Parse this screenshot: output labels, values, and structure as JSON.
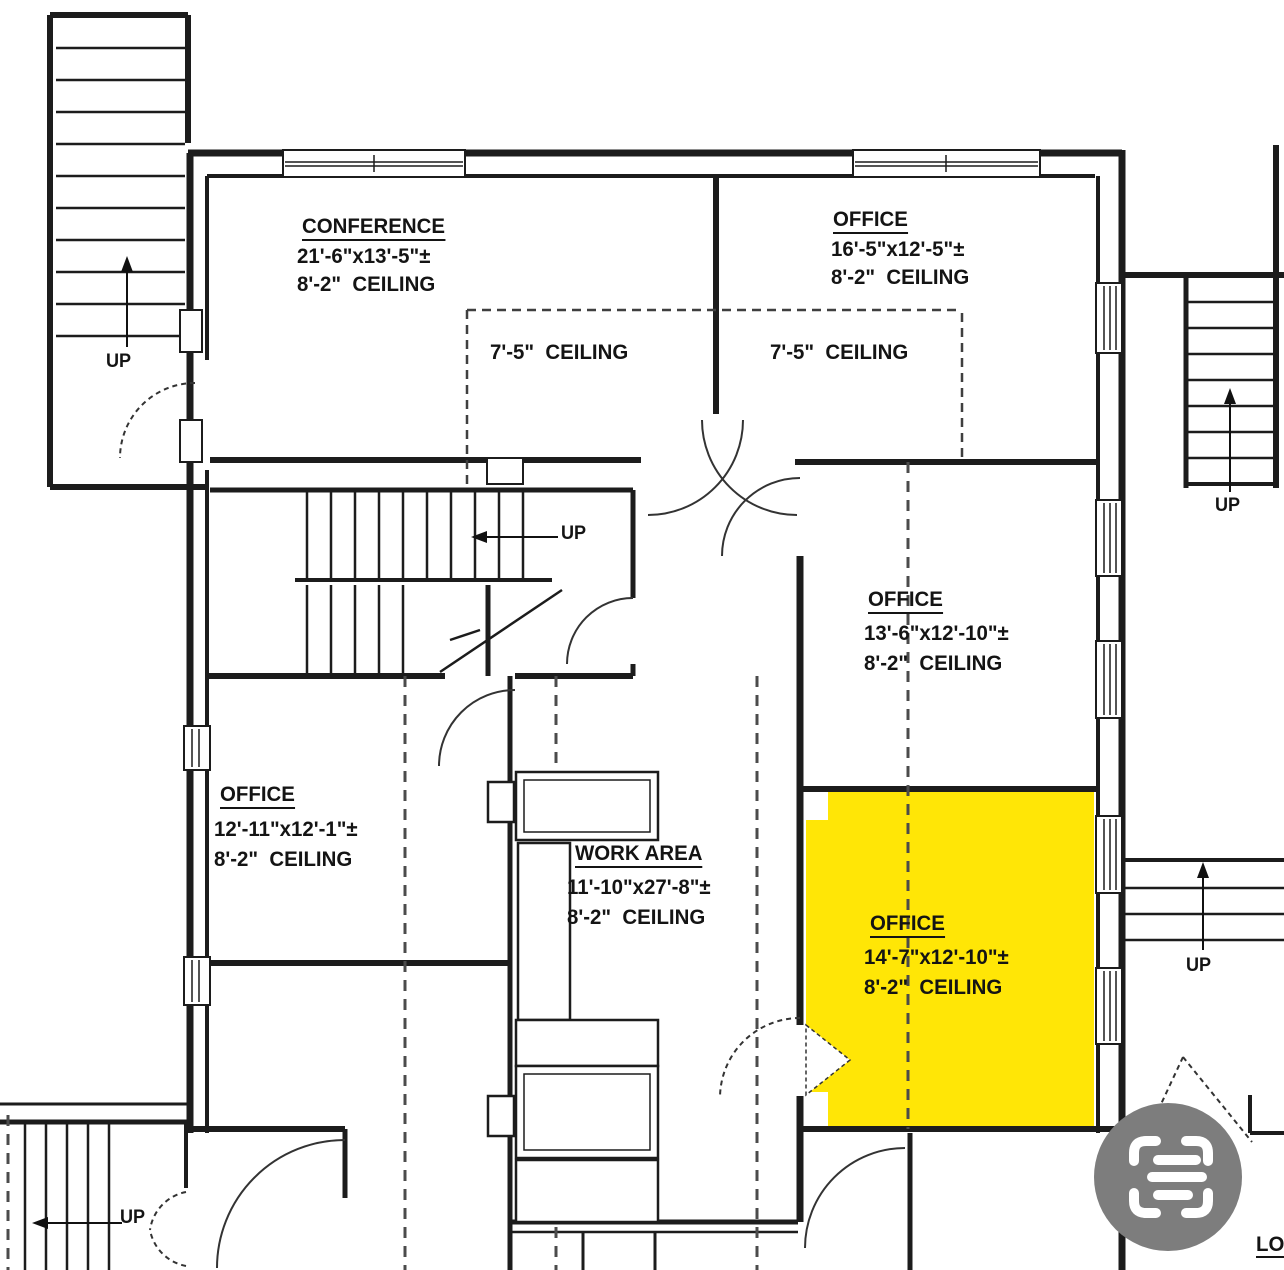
{
  "plan": {
    "colors": {
      "highlight": "#ffe606",
      "wall_line": "#1c1c1c",
      "dash_line": "#4b4b4b",
      "icon_gray": "#7d7d7d"
    },
    "rooms": {
      "conference": {
        "name": "CONFERENCE",
        "dims": "21'-6\"x13'-5\"±",
        "ceiling": "8'-2\"  CEILING"
      },
      "office_ne": {
        "name": "OFFICE",
        "dims": "16'-5\"x12'-5\"±",
        "ceiling": "8'-2\"  CEILING"
      },
      "office_e": {
        "name": "OFFICE",
        "dims": "13'-6\"x12'-10\"±",
        "ceiling": "8'-2\"  CEILING"
      },
      "office_w": {
        "name": "OFFICE",
        "dims": "12'-11\"x12'-1\"±",
        "ceiling": "8'-2\"  CEILING"
      },
      "work_area": {
        "name": "WORK AREA",
        "dims": "11'-10\"x27'-8\"±",
        "ceiling": "8'-2\"  CEILING"
      },
      "office_se": {
        "name": "OFFICE",
        "dims": "14'-7\"x12'-10\"±",
        "ceiling": "8'-2\"  CEILING",
        "highlighted": true
      }
    },
    "notes": {
      "low_ceiling_1": "7'-5\"  CEILING",
      "low_ceiling_2": "7'-5\"  CEILING"
    },
    "stairs": {
      "up_top_left": "UP",
      "up_center": "UP",
      "up_right_top": "UP",
      "up_right_bottom": "UP",
      "up_bottom_left": "UP"
    },
    "partial_label": "LO"
  }
}
